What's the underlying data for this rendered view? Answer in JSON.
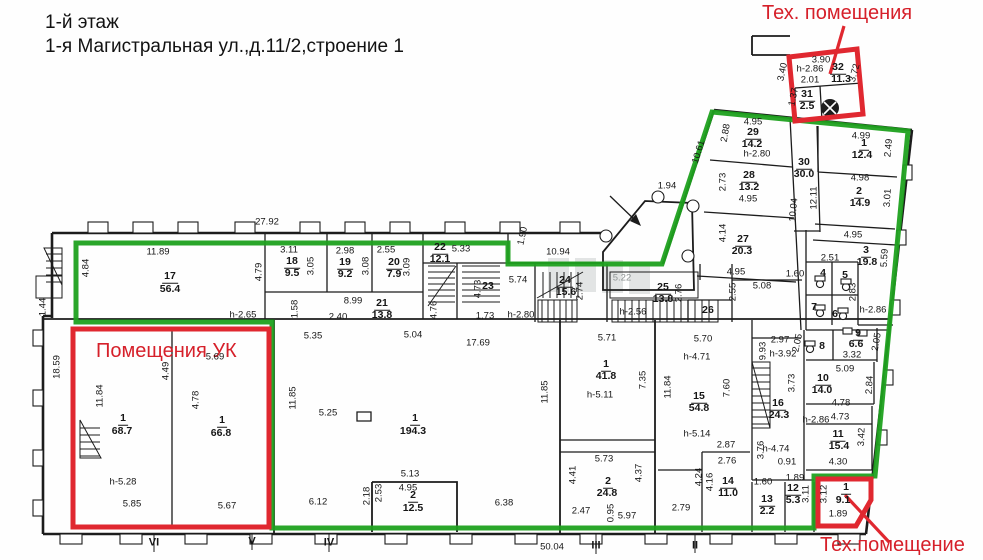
{
  "header": {
    "line1": "1-й этаж",
    "line2": "1-я Магистральная ул.,д.11/2,строение 1"
  },
  "zones": {
    "tech_top": "Тех. помещения",
    "uk": "Помещения УК",
    "tech_bottom": "Тех.помещение"
  },
  "colors": {
    "green": "#1fa11f",
    "red": "#e02830",
    "red_text": "#d6202a",
    "wall": "#1c1c1c"
  },
  "labels": [
    {
      "t": "27.92",
      "x": 267,
      "y": 222,
      "k": "dim"
    },
    {
      "t": "11.89",
      "x": 158,
      "y": 252,
      "k": "dim"
    },
    {
      "t": "4.84",
      "x": 86,
      "y": 268,
      "r": -90,
      "k": "dim"
    },
    {
      "t": "4.79",
      "x": 259,
      "y": 272,
      "r": -90,
      "k": "dim"
    },
    {
      "t": "3.11",
      "x": 289,
      "y": 250,
      "k": "dim"
    },
    {
      "t": "3.05",
      "x": 311,
      "y": 266,
      "r": -90,
      "k": "dim"
    },
    {
      "t": "2.98",
      "x": 345,
      "y": 251,
      "k": "dim"
    },
    {
      "t": "3.08",
      "x": 366,
      "y": 266,
      "r": -90,
      "k": "dim"
    },
    {
      "t": "2.55",
      "x": 386,
      "y": 250,
      "k": "dim"
    },
    {
      "t": "3.09",
      "x": 407,
      "y": 267,
      "r": -90,
      "k": "dim"
    },
    {
      "t": "5.33",
      "x": 461,
      "y": 249,
      "k": "dim"
    },
    {
      "t": "10.94",
      "x": 558,
      "y": 252,
      "k": "dim"
    },
    {
      "t": "1.90",
      "x": 523,
      "y": 236,
      "r": -78,
      "k": "dim"
    },
    {
      "t": "1.44",
      "x": 43,
      "y": 307,
      "r": -90,
      "k": "dim"
    },
    {
      "t": "18.59",
      "x": 57,
      "y": 367,
      "r": -90,
      "k": "dim"
    },
    {
      "t": "h-2.65",
      "x": 243,
      "y": 315,
      "k": "dim"
    },
    {
      "t": "1.58",
      "x": 295,
      "y": 309,
      "r": -90,
      "k": "dim"
    },
    {
      "t": "8.99",
      "x": 353,
      "y": 301,
      "k": "dim"
    },
    {
      "t": "2.40",
      "x": 338,
      "y": 317,
      "k": "dim"
    },
    {
      "t": "4.76",
      "x": 434,
      "y": 310,
      "r": -90,
      "k": "dim"
    },
    {
      "t": "4.73",
      "x": 478,
      "y": 289,
      "r": -90,
      "k": "dim"
    },
    {
      "t": "1.73",
      "x": 485,
      "y": 316,
      "k": "dim"
    },
    {
      "t": "h-2.80",
      "x": 521,
      "y": 315,
      "k": "dim"
    },
    {
      "t": "5.74",
      "x": 518,
      "y": 280,
      "k": "dim"
    },
    {
      "t": "2.74",
      "x": 580,
      "y": 291,
      "r": -90,
      "k": "dim"
    },
    {
      "t": "1.94",
      "x": 667,
      "y": 186,
      "k": "dim"
    },
    {
      "t": "10.61",
      "x": 699,
      "y": 152,
      "r": -73,
      "k": "dim"
    },
    {
      "t": "5.22",
      "x": 622,
      "y": 278,
      "k": "gray"
    },
    {
      "t": "2.76",
      "x": 679,
      "y": 293,
      "r": -90,
      "k": "dim"
    },
    {
      "t": "h-2.56",
      "x": 633,
      "y": 312,
      "k": "dim"
    },
    {
      "t": "5.08",
      "x": 762,
      "y": 286,
      "k": "dim"
    },
    {
      "t": "2.55",
      "x": 733,
      "y": 292,
      "r": -90,
      "k": "dim"
    },
    {
      "t": "1.60",
      "x": 795,
      "y": 274,
      "k": "dim"
    },
    {
      "t": "2.88",
      "x": 726,
      "y": 133,
      "r": -80,
      "k": "dim"
    },
    {
      "t": "4.95",
      "x": 753,
      "y": 122,
      "k": "dim"
    },
    {
      "t": "h-2.80",
      "x": 757,
      "y": 154,
      "k": "dim"
    },
    {
      "t": "2.73",
      "x": 723,
      "y": 182,
      "r": -90,
      "k": "dim"
    },
    {
      "t": "4.95",
      "x": 748,
      "y": 199,
      "k": "dim"
    },
    {
      "t": "4.14",
      "x": 723,
      "y": 233,
      "r": -90,
      "k": "dim"
    },
    {
      "t": "4.95",
      "x": 736,
      "y": 272,
      "k": "dim"
    },
    {
      "t": "10.04",
      "x": 794,
      "y": 210,
      "r": -85,
      "k": "dim"
    },
    {
      "t": "12.11",
      "x": 814,
      "y": 198,
      "r": -90,
      "k": "dim"
    },
    {
      "t": "4.99",
      "x": 861,
      "y": 136,
      "k": "dim"
    },
    {
      "t": "2.49",
      "x": 889,
      "y": 148,
      "r": -85,
      "k": "dim"
    },
    {
      "t": "4.98",
      "x": 860,
      "y": 178,
      "k": "dim"
    },
    {
      "t": "3.01",
      "x": 888,
      "y": 198,
      "r": -87,
      "k": "dim"
    },
    {
      "t": "4.95",
      "x": 853,
      "y": 235,
      "k": "dim"
    },
    {
      "t": "2.51",
      "x": 830,
      "y": 258,
      "k": "dim"
    },
    {
      "t": "5.59",
      "x": 885,
      "y": 258,
      "r": -87,
      "k": "dim"
    },
    {
      "t": "2.83",
      "x": 853,
      "y": 292,
      "r": -90,
      "k": "dim"
    },
    {
      "t": "h-2.86",
      "x": 873,
      "y": 310,
      "k": "dim"
    },
    {
      "t": "2.05",
      "x": 798,
      "y": 343,
      "r": -78,
      "k": "dim"
    },
    {
      "t": "2.05",
      "x": 877,
      "y": 342,
      "r": -80,
      "k": "dim"
    },
    {
      "t": "3.32",
      "x": 852,
      "y": 355,
      "k": "dim"
    },
    {
      "t": "2.97",
      "x": 780,
      "y": 340,
      "k": "dim"
    },
    {
      "t": "h-3.92",
      "x": 783,
      "y": 354,
      "k": "dim"
    },
    {
      "t": "9.93",
      "x": 763,
      "y": 351,
      "r": -90,
      "k": "dim"
    },
    {
      "t": "3.73",
      "x": 792,
      "y": 383,
      "r": -90,
      "k": "dim"
    },
    {
      "t": "5.09",
      "x": 845,
      "y": 369,
      "k": "dim"
    },
    {
      "t": "2.84",
      "x": 870,
      "y": 385,
      "r": -87,
      "k": "dim"
    },
    {
      "t": "4.78",
      "x": 841,
      "y": 403,
      "k": "dim"
    },
    {
      "t": "4.73",
      "x": 840,
      "y": 417,
      "k": "dim"
    },
    {
      "t": "h-2.86",
      "x": 816,
      "y": 420,
      "k": "dim"
    },
    {
      "t": "3.42",
      "x": 862,
      "y": 437,
      "r": -88,
      "k": "dim"
    },
    {
      "t": "4.30",
      "x": 838,
      "y": 462,
      "k": "dim"
    },
    {
      "t": "0.91",
      "x": 787,
      "y": 462,
      "k": "dim"
    },
    {
      "t": "1.89",
      "x": 795,
      "y": 478,
      "k": "dim"
    },
    {
      "t": "h-4.74",
      "x": 776,
      "y": 449,
      "k": "dim"
    },
    {
      "t": "3.76",
      "x": 761,
      "y": 450,
      "r": -90,
      "k": "dim"
    },
    {
      "t": "2.87",
      "x": 726,
      "y": 445,
      "k": "dim"
    },
    {
      "t": "2.76",
      "x": 727,
      "y": 461,
      "k": "dim"
    },
    {
      "t": "h-5.14",
      "x": 697,
      "y": 434,
      "k": "dim"
    },
    {
      "t": "7.60",
      "x": 727,
      "y": 388,
      "r": -90,
      "k": "dim"
    },
    {
      "t": "h-4.71",
      "x": 697,
      "y": 357,
      "k": "dim"
    },
    {
      "t": "5.70",
      "x": 703,
      "y": 339,
      "k": "dim"
    },
    {
      "t": "11.84",
      "x": 668,
      "y": 387,
      "r": -90,
      "k": "dim"
    },
    {
      "t": "7.35",
      "x": 643,
      "y": 380,
      "r": -90,
      "k": "dim"
    },
    {
      "t": "h-5.11",
      "x": 600,
      "y": 395,
      "k": "dim"
    },
    {
      "t": "5.71",
      "x": 607,
      "y": 338,
      "k": "dim"
    },
    {
      "t": "3.90",
      "x": 821,
      "y": 60,
      "k": "dim"
    },
    {
      "t": "h-2.86",
      "x": 810,
      "y": 69,
      "k": "dim"
    },
    {
      "t": "2.01",
      "x": 810,
      "y": 80,
      "k": "dim"
    },
    {
      "t": "3.72",
      "x": 855,
      "y": 73,
      "r": -75,
      "k": "dim"
    },
    {
      "t": "3.40",
      "x": 783,
      "y": 72,
      "r": -78,
      "k": "dim"
    },
    {
      "t": "1.37",
      "x": 794,
      "y": 97,
      "r": -78,
      "k": "dim"
    },
    {
      "t": "5.69",
      "x": 215,
      "y": 357,
      "k": "dim"
    },
    {
      "t": "4.49",
      "x": 166,
      "y": 371,
      "r": -90,
      "k": "dim"
    },
    {
      "t": "11.84",
      "x": 100,
      "y": 396,
      "r": -90,
      "k": "dim"
    },
    {
      "t": "4.78",
      "x": 196,
      "y": 400,
      "r": -90,
      "k": "dim"
    },
    {
      "t": "h-5.28",
      "x": 123,
      "y": 482,
      "k": "dim"
    },
    {
      "t": "5.85",
      "x": 132,
      "y": 504,
      "k": "dim"
    },
    {
      "t": "5.67",
      "x": 227,
      "y": 506,
      "k": "dim"
    },
    {
      "t": "5.35",
      "x": 313,
      "y": 336,
      "k": "dim"
    },
    {
      "t": "5.04",
      "x": 413,
      "y": 335,
      "k": "dim"
    },
    {
      "t": "17.69",
      "x": 478,
      "y": 343,
      "k": "dim"
    },
    {
      "t": "11.85",
      "x": 293,
      "y": 398,
      "r": -90,
      "k": "dim"
    },
    {
      "t": "11.85",
      "x": 545,
      "y": 392,
      "r": -90,
      "k": "dim"
    },
    {
      "t": "5.25",
      "x": 328,
      "y": 413,
      "k": "dim"
    },
    {
      "t": "5.13",
      "x": 410,
      "y": 474,
      "k": "dim"
    },
    {
      "t": "4.95",
      "x": 408,
      "y": 488,
      "k": "dim"
    },
    {
      "t": "2.18",
      "x": 367,
      "y": 496,
      "r": -90,
      "k": "dim"
    },
    {
      "t": "2.53",
      "x": 379,
      "y": 493,
      "r": -90,
      "k": "dim"
    },
    {
      "t": "6.12",
      "x": 318,
      "y": 502,
      "k": "dim"
    },
    {
      "t": "6.38",
      "x": 504,
      "y": 503,
      "k": "dim"
    },
    {
      "t": "5.73",
      "x": 604,
      "y": 459,
      "k": "dim"
    },
    {
      "t": "4.41",
      "x": 573,
      "y": 475,
      "r": -90,
      "k": "dim"
    },
    {
      "t": "4.37",
      "x": 639,
      "y": 473,
      "r": -90,
      "k": "dim"
    },
    {
      "t": "2.47",
      "x": 581,
      "y": 511,
      "k": "dim"
    },
    {
      "t": "0.95",
      "x": 611,
      "y": 513,
      "r": -90,
      "k": "dim"
    },
    {
      "t": "5.97",
      "x": 627,
      "y": 516,
      "k": "dim"
    },
    {
      "t": "2.79",
      "x": 681,
      "y": 508,
      "k": "dim"
    },
    {
      "t": "4.24",
      "x": 699,
      "y": 477,
      "r": -90,
      "k": "dim"
    },
    {
      "t": "4.16",
      "x": 710,
      "y": 482,
      "r": -90,
      "k": "dim"
    },
    {
      "t": "1.60",
      "x": 763,
      "y": 482,
      "k": "dim"
    },
    {
      "t": "3.11",
      "x": 806,
      "y": 494,
      "r": -90,
      "k": "dim"
    },
    {
      "t": "3.12",
      "x": 824,
      "y": 494,
      "r": -90,
      "k": "dim"
    },
    {
      "t": "1.89",
      "x": 838,
      "y": 514,
      "k": "dim"
    },
    {
      "t": "50.04",
      "x": 552,
      "y": 547,
      "k": "dim"
    },
    {
      "t": "VI",
      "x": 154,
      "y": 543,
      "k": "axis"
    },
    {
      "t": "V",
      "x": 252,
      "y": 542,
      "k": "axis"
    },
    {
      "t": "IV",
      "x": 329,
      "y": 543,
      "k": "axis"
    },
    {
      "t": "III",
      "x": 596,
      "y": 546,
      "k": "axis"
    },
    {
      "t": "II",
      "x": 695,
      "y": 546,
      "k": "axis"
    },
    {
      "t": "17",
      "x": 170,
      "y": 277,
      "k": "room"
    },
    {
      "t": "56.4",
      "x": 170,
      "y": 289,
      "k": "area"
    },
    {
      "t": "18",
      "x": 292,
      "y": 262,
      "k": "room"
    },
    {
      "t": "9.5",
      "x": 292,
      "y": 273,
      "k": "area"
    },
    {
      "t": "19",
      "x": 345,
      "y": 263,
      "k": "room"
    },
    {
      "t": "9.2",
      "x": 345,
      "y": 274,
      "k": "area"
    },
    {
      "t": "20",
      "x": 394,
      "y": 263,
      "k": "room"
    },
    {
      "t": "7.9",
      "x": 394,
      "y": 274,
      "k": "area"
    },
    {
      "t": "21",
      "x": 382,
      "y": 304,
      "k": "room"
    },
    {
      "t": "13.8",
      "x": 382,
      "y": 315,
      "k": "area"
    },
    {
      "t": "22",
      "x": 440,
      "y": 248,
      "k": "room"
    },
    {
      "t": "12.1",
      "x": 440,
      "y": 259,
      "k": "area"
    },
    {
      "t": "24",
      "x": 565,
      "y": 281,
      "k": "room"
    },
    {
      "t": "15.6",
      "x": 566,
      "y": 292,
      "k": "area"
    },
    {
      "t": "25",
      "x": 663,
      "y": 288,
      "k": "room"
    },
    {
      "t": "13.8",
      "x": 663,
      "y": 299,
      "k": "area"
    },
    {
      "t": "29",
      "x": 753,
      "y": 133,
      "k": "room"
    },
    {
      "t": "14.2",
      "x": 752,
      "y": 144,
      "k": "area"
    },
    {
      "t": "28",
      "x": 749,
      "y": 176,
      "k": "room"
    },
    {
      "t": "13.2",
      "x": 749,
      "y": 187,
      "k": "area"
    },
    {
      "t": "27",
      "x": 743,
      "y": 240,
      "k": "room"
    },
    {
      "t": "20.3",
      "x": 742,
      "y": 251,
      "k": "area"
    },
    {
      "t": "30",
      "x": 804,
      "y": 163,
      "k": "room"
    },
    {
      "t": "30.0",
      "x": 804,
      "y": 174,
      "k": "area"
    },
    {
      "t": "32",
      "x": 838,
      "y": 68,
      "k": "room"
    },
    {
      "t": "11.3",
      "x": 841,
      "y": 79,
      "k": "area"
    },
    {
      "t": "31",
      "x": 807,
      "y": 95,
      "k": "room"
    },
    {
      "t": "2.5",
      "x": 807,
      "y": 106,
      "k": "area"
    },
    {
      "t": "1",
      "x": 864,
      "y": 144,
      "k": "room"
    },
    {
      "t": "12.4",
      "x": 862,
      "y": 155,
      "k": "area"
    },
    {
      "t": "2",
      "x": 859,
      "y": 192,
      "k": "room"
    },
    {
      "t": "14.9",
      "x": 860,
      "y": 203,
      "k": "area"
    },
    {
      "t": "3",
      "x": 866,
      "y": 251,
      "k": "room"
    },
    {
      "t": "19.8",
      "x": 867,
      "y": 262,
      "k": "area"
    },
    {
      "t": "9",
      "x": 858,
      "y": 334,
      "k": "room"
    },
    {
      "t": "6.6",
      "x": 856,
      "y": 344,
      "k": "area"
    },
    {
      "t": "10",
      "x": 823,
      "y": 379,
      "k": "room"
    },
    {
      "t": "14.0",
      "x": 822,
      "y": 390,
      "k": "area"
    },
    {
      "t": "11",
      "x": 838,
      "y": 435,
      "k": "room"
    },
    {
      "t": "15.4",
      "x": 839,
      "y": 446,
      "k": "area"
    },
    {
      "t": "16",
      "x": 778,
      "y": 404,
      "k": "room"
    },
    {
      "t": "24.3",
      "x": 779,
      "y": 415,
      "k": "area"
    },
    {
      "t": "1",
      "x": 606,
      "y": 365,
      "k": "room"
    },
    {
      "t": "41.8",
      "x": 606,
      "y": 376,
      "k": "area"
    },
    {
      "t": "15",
      "x": 699,
      "y": 397,
      "k": "room"
    },
    {
      "t": "54.8",
      "x": 699,
      "y": 408,
      "k": "area"
    },
    {
      "t": "2",
      "x": 608,
      "y": 482,
      "k": "room"
    },
    {
      "t": "24.8",
      "x": 607,
      "y": 493,
      "k": "area"
    },
    {
      "t": "14",
      "x": 728,
      "y": 482,
      "k": "room"
    },
    {
      "t": "11.0",
      "x": 728,
      "y": 493,
      "k": "area"
    },
    {
      "t": "13",
      "x": 767,
      "y": 500,
      "k": "room"
    },
    {
      "t": "2.2",
      "x": 767,
      "y": 511,
      "k": "area"
    },
    {
      "t": "12",
      "x": 793,
      "y": 489,
      "k": "room"
    },
    {
      "t": "5.3",
      "x": 793,
      "y": 500,
      "k": "area"
    },
    {
      "t": "1",
      "x": 846,
      "y": 488,
      "k": "room"
    },
    {
      "t": "9.1",
      "x": 843,
      "y": 500,
      "k": "area"
    },
    {
      "t": "1",
      "x": 123,
      "y": 419,
      "k": "room"
    },
    {
      "t": "68.7",
      "x": 122,
      "y": 431,
      "k": "area"
    },
    {
      "t": "1",
      "x": 222,
      "y": 421,
      "k": "room"
    },
    {
      "t": "66.8",
      "x": 221,
      "y": 433,
      "k": "area"
    },
    {
      "t": "1",
      "x": 415,
      "y": 419,
      "k": "room"
    },
    {
      "t": "194.3",
      "x": 413,
      "y": 431,
      "k": "area"
    },
    {
      "t": "2",
      "x": 413,
      "y": 496,
      "k": "room"
    },
    {
      "t": "12.5",
      "x": 413,
      "y": 508,
      "k": "area"
    },
    {
      "t": "4",
      "x": 823,
      "y": 273,
      "k": "num"
    },
    {
      "t": "5",
      "x": 845,
      "y": 275,
      "k": "num"
    },
    {
      "t": "7",
      "x": 814,
      "y": 307,
      "k": "num"
    },
    {
      "t": "6",
      "x": 835,
      "y": 314,
      "k": "num"
    },
    {
      "t": "8",
      "x": 822,
      "y": 346,
      "k": "num"
    },
    {
      "t": "26",
      "x": 708,
      "y": 310,
      "k": "num"
    },
    {
      "t": "23",
      "x": 488,
      "y": 286,
      "k": "num"
    }
  ]
}
